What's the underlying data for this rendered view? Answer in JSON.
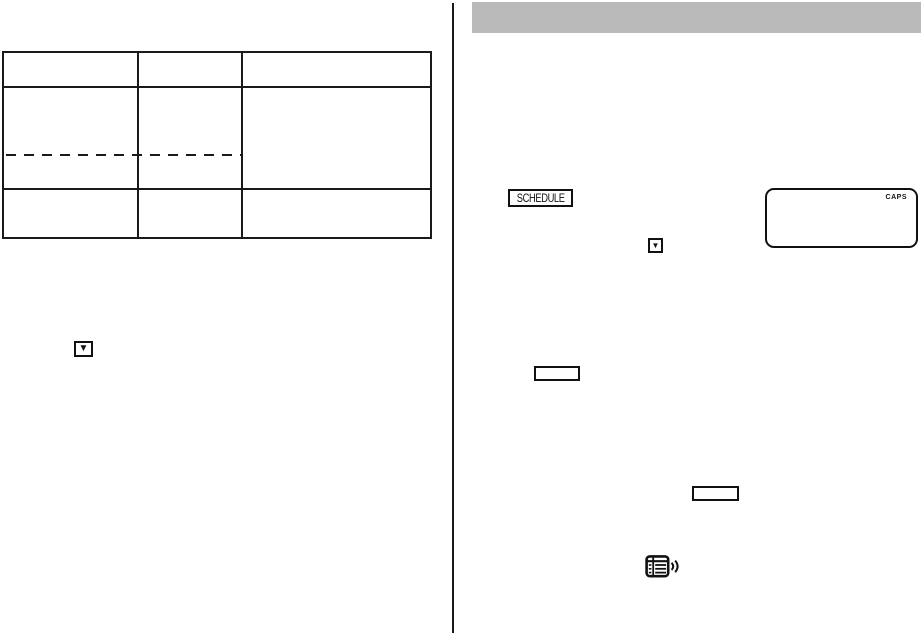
{
  "colors": {
    "header_bar": "#b9b9b9",
    "line": "#1a1a1a",
    "background": "#ffffff"
  },
  "left_page": {
    "table": {
      "columns": 3,
      "rows": 3,
      "cells_empty": true,
      "dashed_row_split": true
    },
    "down_key": {
      "glyph": "▼"
    }
  },
  "right_page": {
    "header_bar": {
      "title": ""
    },
    "schedule_key": {
      "label": "SCHEDULE"
    },
    "display": {
      "indicator": "CAPS",
      "content": ""
    },
    "down_key": {
      "glyph": "▼"
    },
    "blank_key_1": {
      "label": ""
    },
    "blank_key_2": {
      "label": ""
    },
    "icons": {
      "beep": "list-with-sound-waves-icon"
    }
  }
}
